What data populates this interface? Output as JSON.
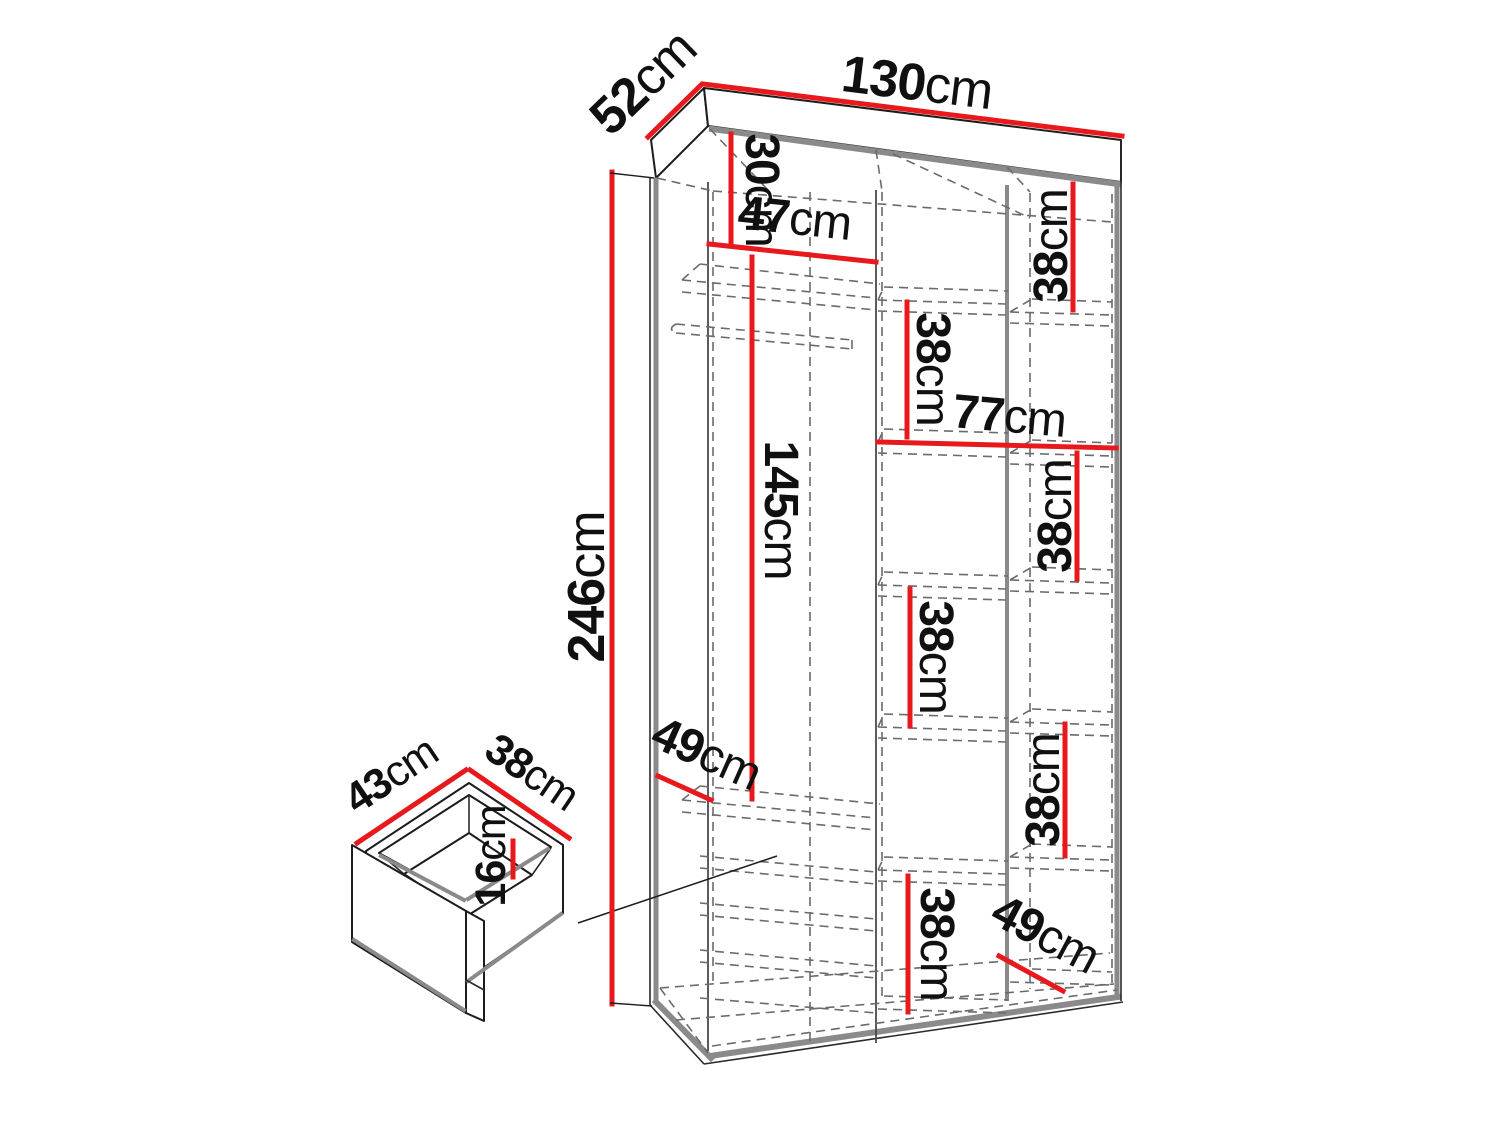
{
  "diagram": {
    "type": "furniture-dimension-diagram",
    "subject": "wardrobe-interior-with-drawer-detail",
    "unit": "cm",
    "colors": {
      "dimension_line": "#e8191d",
      "outline": "#1c1c1c",
      "panel_grey": "#8a8a8a",
      "hidden_edge_grey": "#6b6b6b",
      "background": "#ffffff"
    },
    "labels": {
      "width": {
        "value": "130",
        "unit": "cm"
      },
      "depth": {
        "value": "52",
        "unit": "cm"
      },
      "height": {
        "value": "246",
        "unit": "cm"
      },
      "top_section": {
        "value": "30",
        "unit": "cm"
      },
      "left_section_w": {
        "value": "47",
        "unit": "cm"
      },
      "hanging_space": {
        "value": "145",
        "unit": "cm"
      },
      "left_shelf_depth": {
        "value": "49",
        "unit": "cm"
      },
      "right_section_w": {
        "value": "77",
        "unit": "cm"
      },
      "shelf_right_1": {
        "value": "38",
        "unit": "cm"
      },
      "shelf_mid_1": {
        "value": "38",
        "unit": "cm"
      },
      "shelf_right_2": {
        "value": "38",
        "unit": "cm"
      },
      "shelf_mid_2": {
        "value": "38",
        "unit": "cm"
      },
      "shelf_right_3": {
        "value": "38",
        "unit": "cm"
      },
      "shelf_mid_3": {
        "value": "38",
        "unit": "cm"
      },
      "bottom_shelf_depth": {
        "value": "49",
        "unit": "cm"
      },
      "drawer_width": {
        "value": "43",
        "unit": "cm"
      },
      "drawer_depth": {
        "value": "38",
        "unit": "cm"
      },
      "drawer_height": {
        "value": "16",
        "unit": "cm"
      }
    }
  }
}
